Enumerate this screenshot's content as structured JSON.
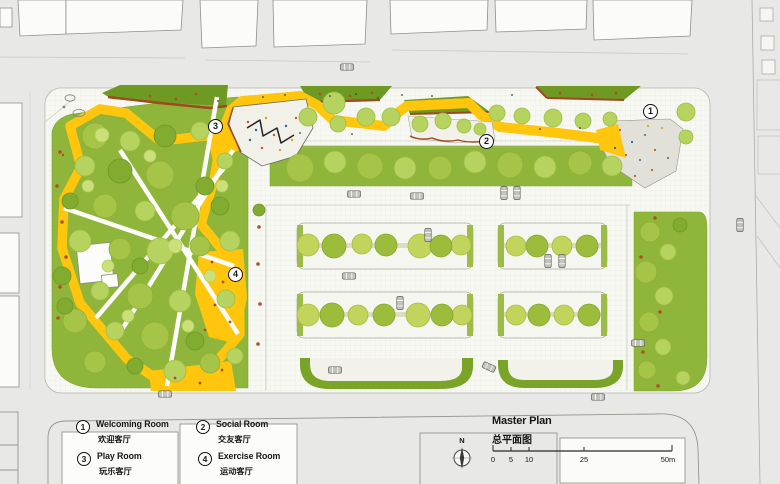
{
  "plan": {
    "markers": [
      {
        "num": "1"
      },
      {
        "num": "2"
      },
      {
        "num": "3"
      },
      {
        "num": "4"
      }
    ]
  },
  "legend": {
    "items": [
      {
        "num": "1",
        "en": "Welcoming Room",
        "zh": "欢迎客厅"
      },
      {
        "num": "2",
        "en": "Social Room",
        "zh": "交友客厅"
      },
      {
        "num": "3",
        "en": "Play Room",
        "zh": "玩乐客厅"
      },
      {
        "num": "4",
        "en": "Exercise Room",
        "zh": "运动客厅"
      }
    ]
  },
  "titleblock": {
    "title_en": "Master Plan",
    "title_zh": "总平面图",
    "north": "N",
    "scale_labels": [
      "0",
      "5",
      "10",
      "25",
      "50m"
    ]
  },
  "colors": {
    "path_yellow": "#FFC60D",
    "park_green": "#8FB63A",
    "dark_green": "#6E9A24",
    "earth_brown": "#9C4A1F",
    "road_gray": "#E8E8E6"
  }
}
